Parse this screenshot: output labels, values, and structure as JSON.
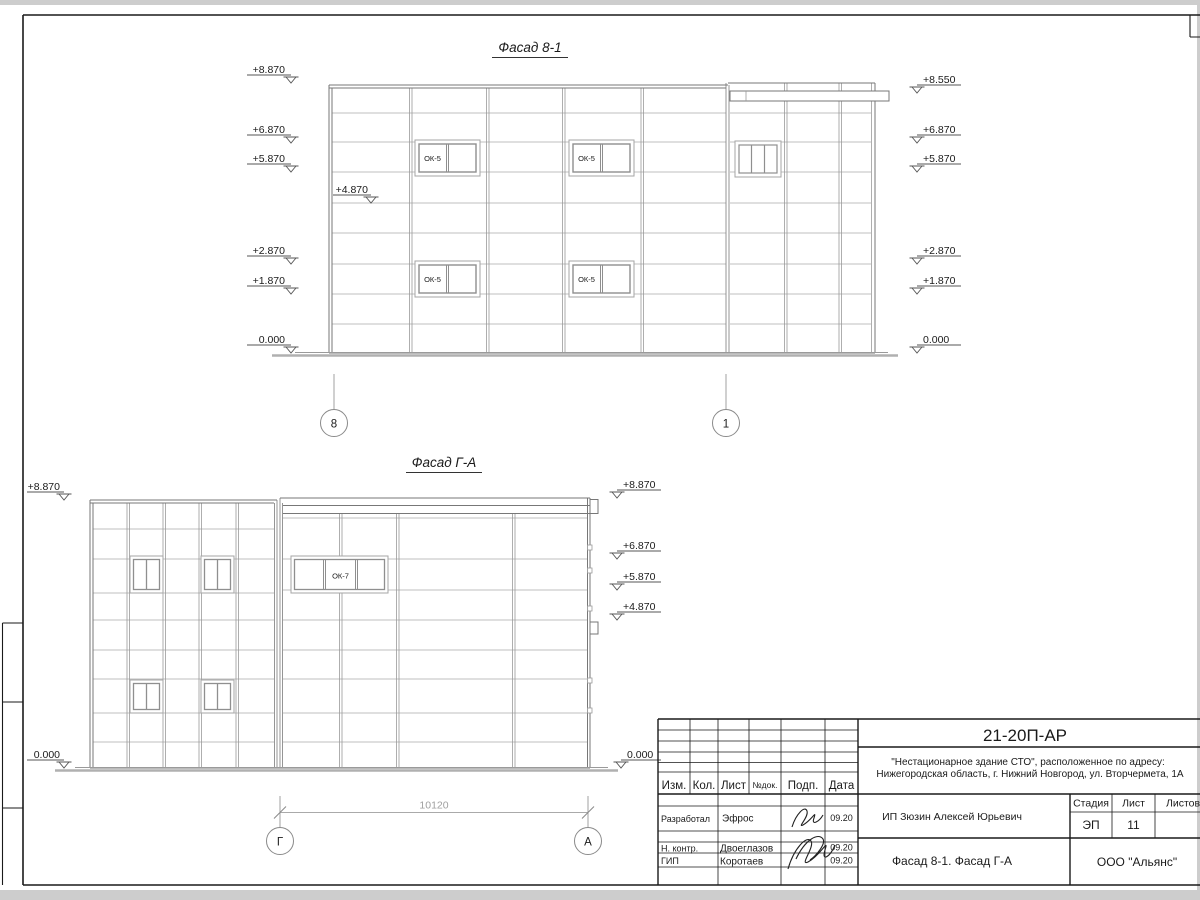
{
  "sheet": {
    "doc_number": "21-20П-АР",
    "project_line1": "\"Нестационарное здание СТО\", расположенное по адресу:",
    "project_line2": "Нижегородская область, г. Нижний Новгород, ул. Вторчермета, 1А",
    "client": "ИП Зюзин Алексей Юрьевич",
    "sheet_title": "Фасад 8-1. Фасад Г-А",
    "company": "ООО \"Альянс\"",
    "stage_label": "Стадия",
    "stage_value": "ЭП",
    "sheet_label": "Лист",
    "sheet_value": "11",
    "sheets_label": "Листов",
    "columns": {
      "izm": "Изм.",
      "kol": "Кол.",
      "list": "Лист",
      "ndok": "№док.",
      "podp": "Подп.",
      "data": "Дата"
    },
    "roles": [
      {
        "role": "Разработал",
        "name": "Эфрос",
        "date": "09.20"
      },
      {
        "role": "Н. контр.",
        "name": "Двоеглазов",
        "date": "09.20"
      },
      {
        "role": "ГИП",
        "name": "Коротаев",
        "date": "09.20"
      }
    ]
  },
  "facade1": {
    "title": "Фасад 8-1",
    "marks_left": [
      "+8.870",
      "+6.870",
      "+5.870",
      "+2.870",
      "+1.870",
      "0.000"
    ],
    "mark_inner": "+4.870",
    "marks_right": [
      "+8.550",
      "+6.870",
      "+5.870",
      "+2.870",
      "+1.870",
      "0.000"
    ],
    "window_label": "ОК-5",
    "axis_left": "8",
    "axis_right": "1"
  },
  "facade2": {
    "title": "Фасад Г-А",
    "marks_left": [
      "+8.870",
      "0.000"
    ],
    "marks_right": [
      "+8.870",
      "+6.870",
      "+5.870",
      "+4.870",
      "0.000"
    ],
    "window_label": "ОК-7",
    "axis_left": "Г",
    "axis_right": "А",
    "dimension": "10120"
  }
}
